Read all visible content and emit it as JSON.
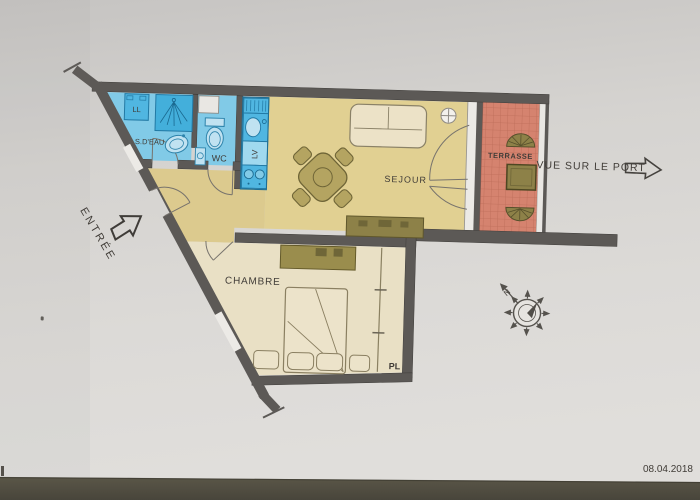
{
  "photo": {
    "date_stamp": "08.04.2018"
  },
  "plan": {
    "labels": {
      "entree": "ENTRÉE",
      "s_deau": "S.D'EAU",
      "ll": "LL",
      "lv": "LV",
      "wc": "WC",
      "sejour": "SEJOUR",
      "chambre": "CHAMBRE",
      "terrasse": "TERRASSE",
      "pl": "PL",
      "vue_sur_le_port": "VUE SUR LE PORT",
      "north": "N"
    },
    "colors": {
      "wall": "#5c5956",
      "floor_main": "#e2d08f",
      "floor_hall": "#ddca8b",
      "floor_bedroom": "#e9e0c4",
      "wet_room_floor": "#7ecbe9",
      "fixture_blue": "#4db7e4",
      "fixture_outline": "#1f7aa6",
      "terrace_tile": "#d8826e",
      "terrace_grout": "#bf6b57",
      "furniture_olive": "#b5a45e",
      "furniture_dark_olive": "#8e8146",
      "bed_cream": "#ece3c9",
      "paper": "#d7d5d2",
      "table_surface": "#514e41",
      "ink": "#403c37"
    }
  }
}
